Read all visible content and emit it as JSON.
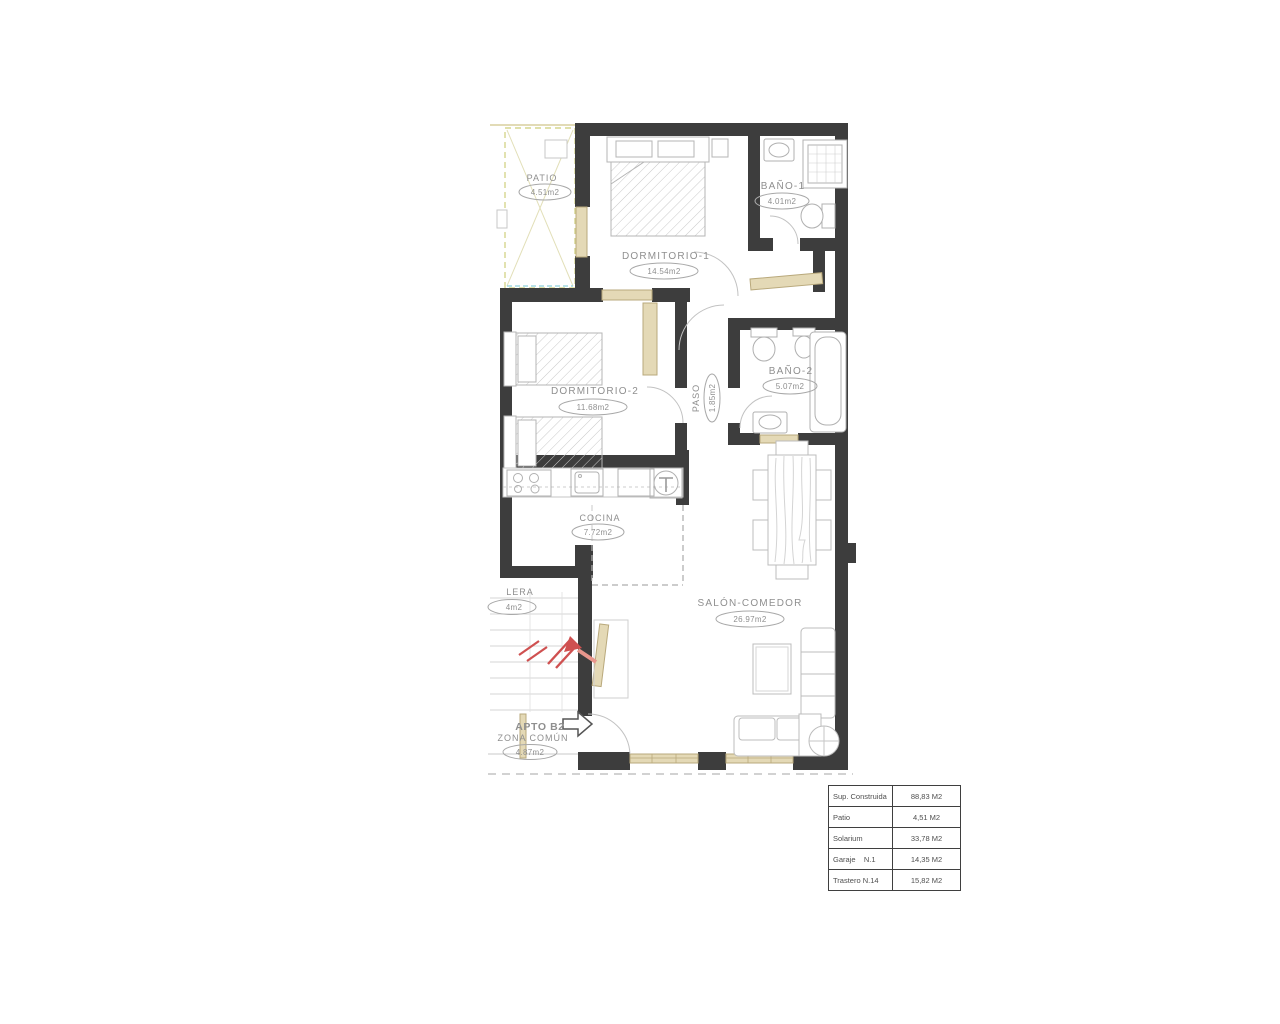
{
  "plan": {
    "apartment_label": "APTO B2",
    "rooms": {
      "patio": {
        "name": "PATIO",
        "area": "4.51m2"
      },
      "dormitorio1": {
        "name": "DORMITORIO-1",
        "area": "14.54m2"
      },
      "bano1": {
        "name": "BAÑO-1",
        "area": "4.01m2"
      },
      "dormitorio2": {
        "name": "DORMITORIO-2",
        "area": "11.68m2"
      },
      "bano2": {
        "name": "BAÑO-2",
        "area": "5.07m2"
      },
      "paso": {
        "name": "PASO",
        "area": "1.85m2"
      },
      "cocina": {
        "name": "COCINA",
        "area": "7.72m2"
      },
      "salon": {
        "name": "SALÓN-COMEDOR",
        "area": "26.97m2"
      },
      "zona_comun": {
        "name": "ZONA COMÚN",
        "area": "4.87m2"
      },
      "escalera": {
        "name": "LERA",
        "area": "4m2"
      }
    }
  },
  "summary": {
    "rows": [
      {
        "label": "Sup. Construida",
        "value": "88,83 M2"
      },
      {
        "label": "Patio",
        "value": "4,51 M2"
      },
      {
        "label": "Solarium",
        "value": "33,78 M2"
      },
      {
        "label": "Garaje    N.1",
        "value": "14,35 M2"
      },
      {
        "label": "Trastero N.14",
        "value": "15,82 M2"
      }
    ]
  },
  "colors": {
    "wall": "#3d3d3d",
    "carpentry_tan": "#d2c39a",
    "patio_line": "#d6d68e",
    "accent_green": "#76b041",
    "stair_arrow_red": "#cf5050",
    "furniture_line": "#b5b5b5"
  }
}
